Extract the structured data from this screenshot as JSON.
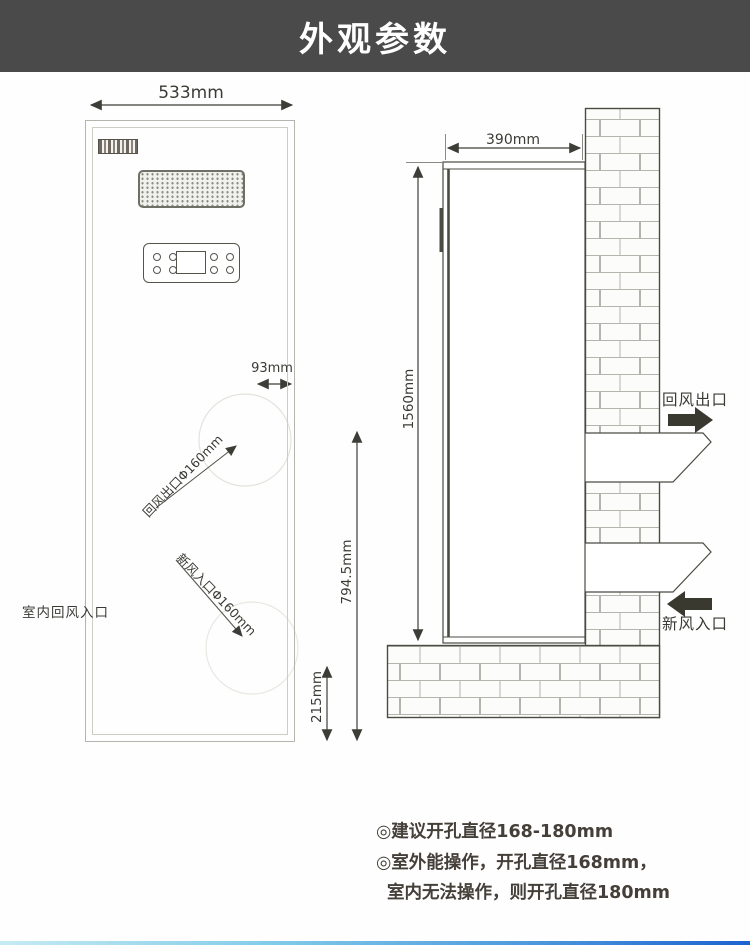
{
  "header": {
    "title": "外观参数"
  },
  "front_view": {
    "width_dim": "533mm",
    "hole_offset_dim": "93mm",
    "return_outlet_label": "回风出口Φ160mm",
    "fresh_inlet_label": "新风入口Φ160mm",
    "indoor_return_label": "室内回风入口",
    "bottom_offset_dim": "215mm",
    "outlet_height_dim": "794.5mm"
  },
  "side_view": {
    "depth_dim": "390mm",
    "height_dim": "1560mm",
    "return_outlet_label": "回风出口",
    "fresh_inlet_label": "新风入口"
  },
  "notes": {
    "line1": "◎建议开孔直径168-180mm",
    "line2": "◎室外能操作，开孔直径168mm，",
    "line3": "室内无法操作，则开孔直径180mm"
  },
  "colors": {
    "header_bg": "#4a4a4a",
    "line": "#4b4b43",
    "accent_bar_start": "#c6ebf3",
    "accent_bar_end": "#1b63cf"
  }
}
